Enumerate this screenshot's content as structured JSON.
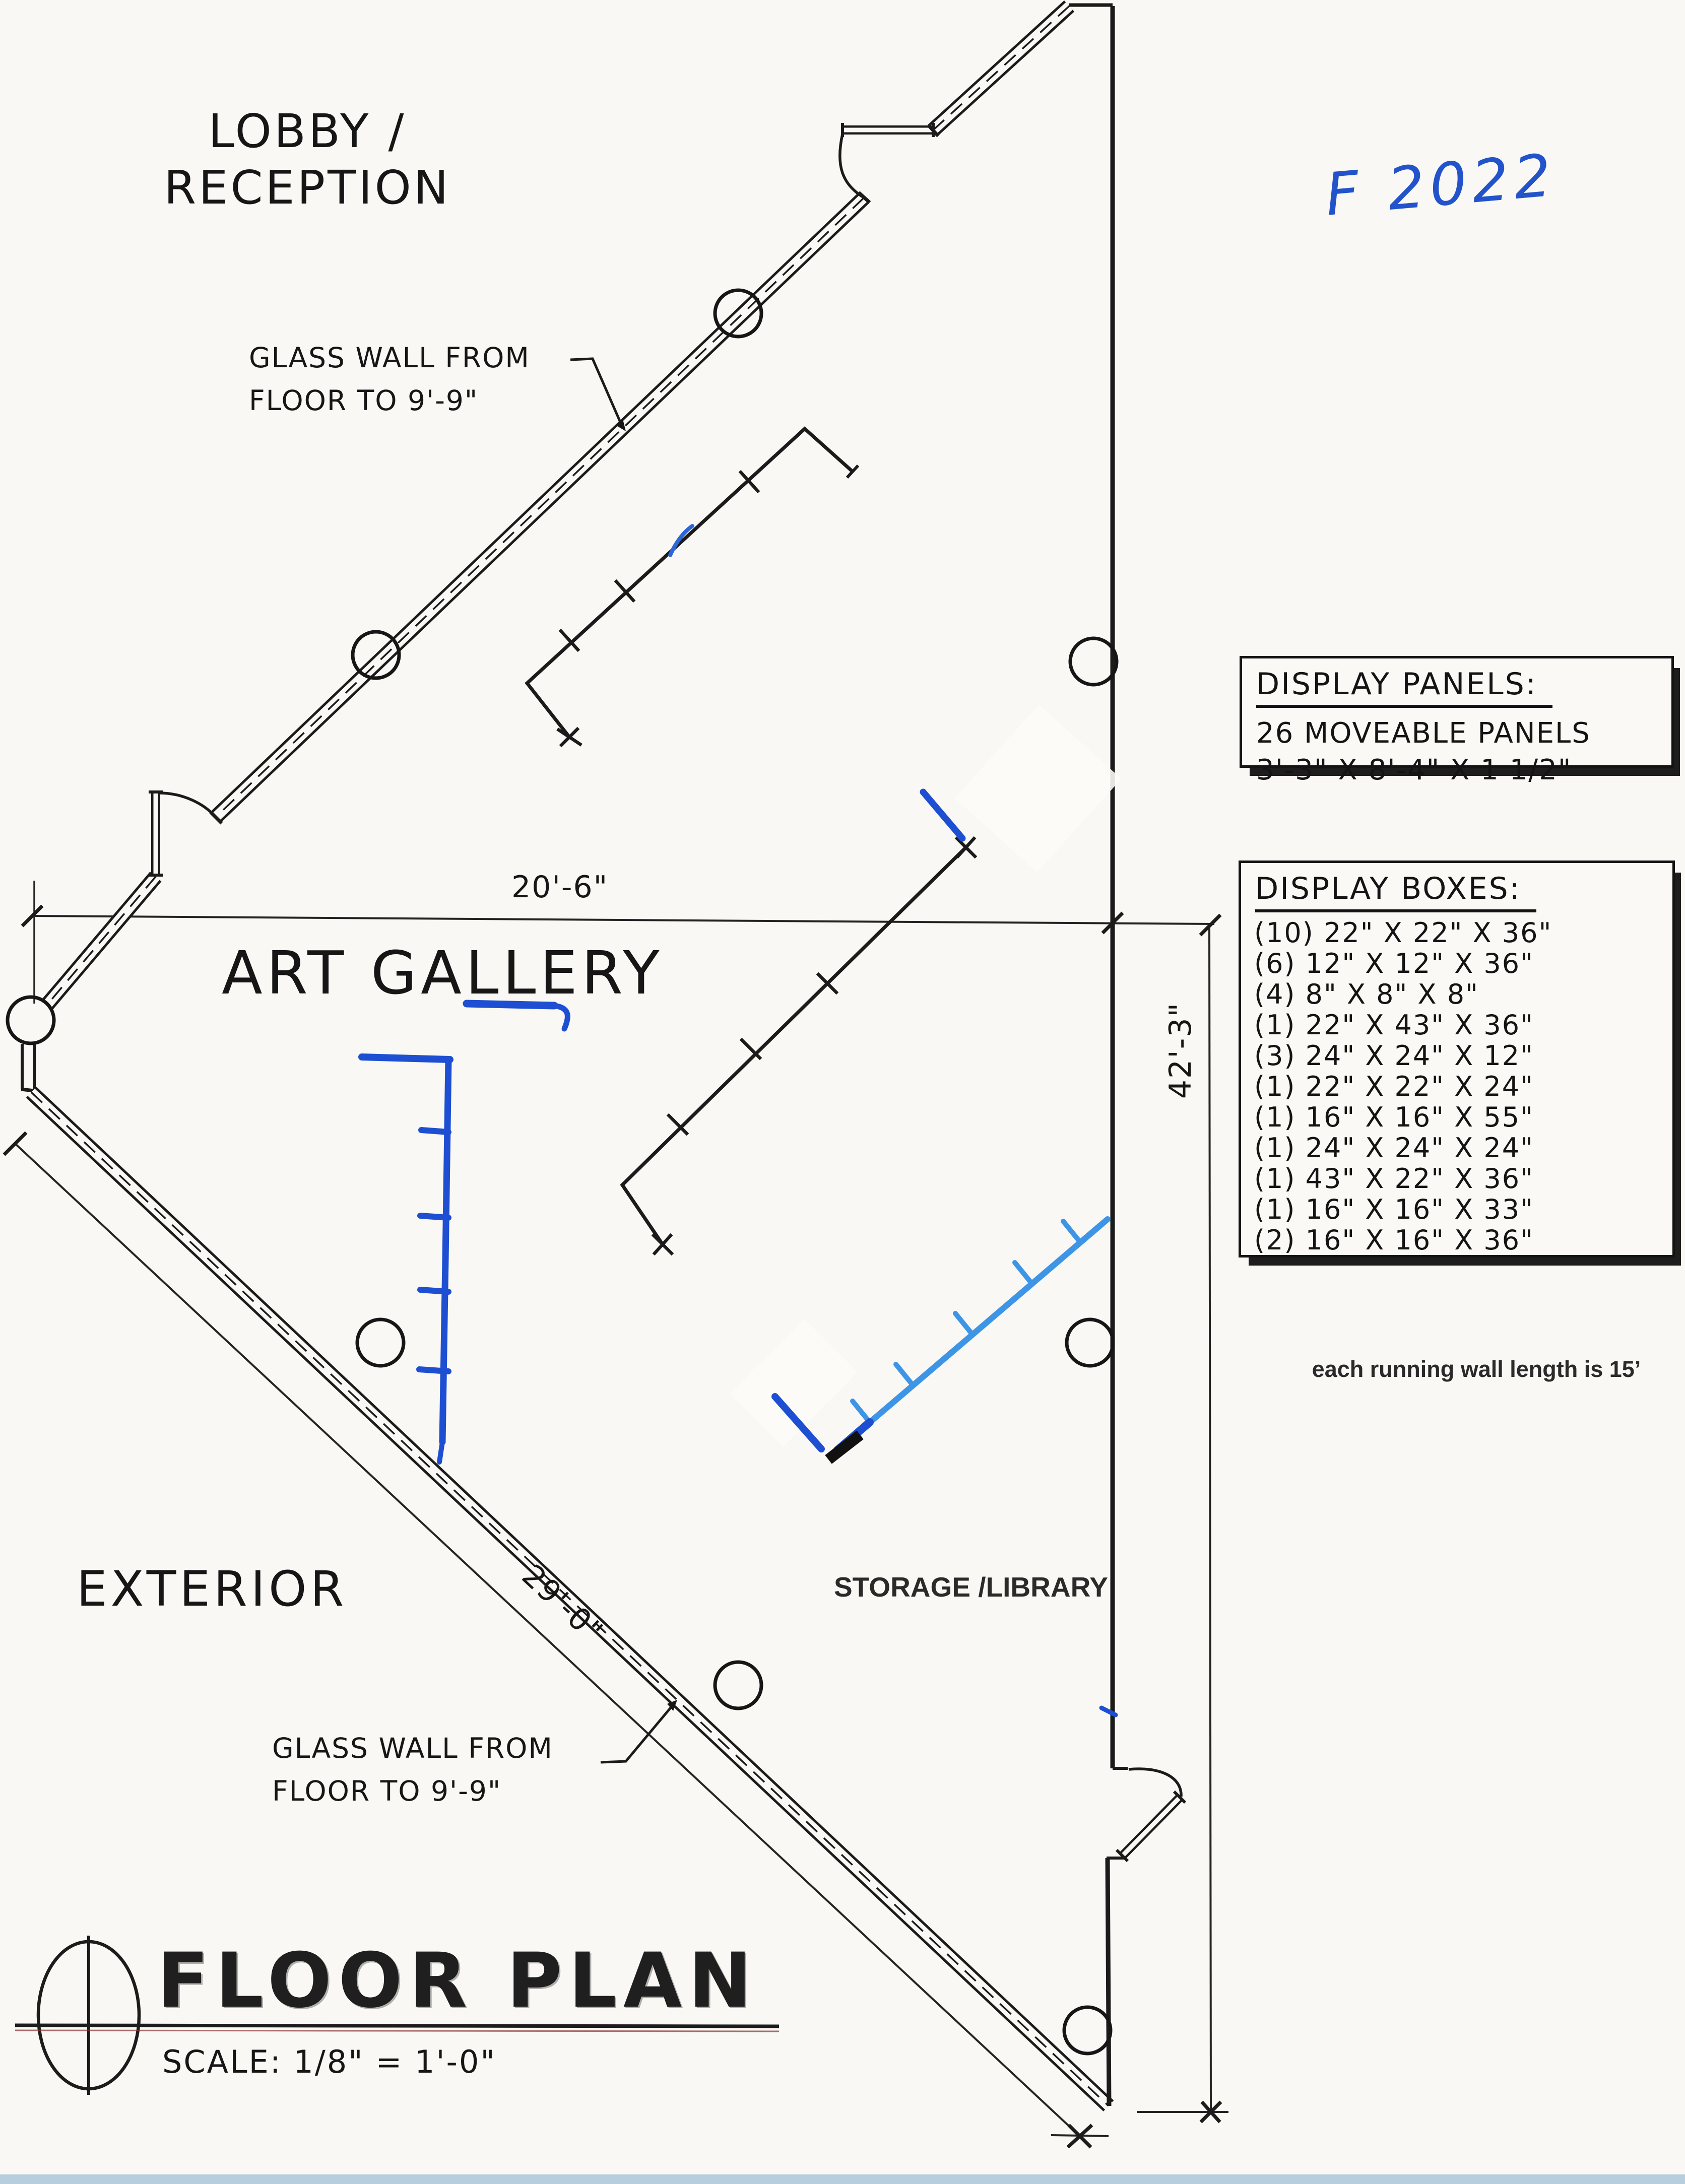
{
  "labels": {
    "lobby_line1": "LOBBY /",
    "lobby_line2": "RECEPTION",
    "art_gallery": "ART GALLERY",
    "exterior": "EXTERIOR",
    "storage_library": "STORAGE /LIBRARY"
  },
  "notes": {
    "glass_wall_upper_line1": "GLASS WALL FROM",
    "glass_wall_upper_line2": "FLOOR TO 9'-9\"",
    "glass_wall_lower_line1": "GLASS WALL FROM",
    "glass_wall_lower_line2": "FLOOR TO 9'-9\"",
    "running_wall": "each running wall length is 15’",
    "handwritten": "F 2022"
  },
  "dimensions": {
    "gallery_width": "20'-6\"",
    "east_wall": "42'-3\"",
    "glass_wall_diagonal": "29'-0\""
  },
  "display_panels": {
    "title": "DISPLAY PANELS:",
    "count_line": "26 MOVEABLE PANELS",
    "size_line": "3'-3\" X 8'-4\" X 1 1/2\""
  },
  "display_boxes": {
    "title": "DISPLAY BOXES:",
    "items": [
      "(10) 22\" X 22\" X 36\"",
      "(6) 12\" X 12\" X 36\"",
      "(4) 8\" X 8\" X 8\"",
      "(1) 22\" X 43\" X 36\"",
      "(3) 24\" X 24\" X 12\"",
      "(1) 22\" X 22\" X 24\"",
      "(1) 16\" X 16\" X 55\"",
      "(1) 24\" X 24\" X 24\"",
      "(1) 43\" X 22\" X 36\"",
      "(1) 16\" X 16\" X 33\"",
      "(2) 16\" X 16\" X 36\""
    ]
  },
  "titleblock": {
    "title": "FLOOR PLAN",
    "scale": "SCALE: 1/8\" = 1'-0\""
  },
  "colors": {
    "ink": "#1b1b1b",
    "pen_dark_blue": "#1e4fd2",
    "pen_light_blue": "#3f95e5",
    "handwriting_blue": "#2353cb",
    "scan_strip": "#b6cedd"
  }
}
